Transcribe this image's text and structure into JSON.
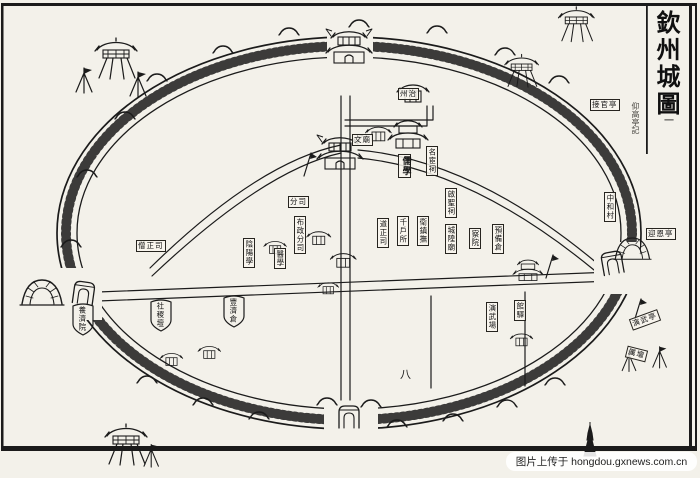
{
  "title": {
    "text": "欽州城圖",
    "volume_mark": "一",
    "side_note": "仰高亭記"
  },
  "watermark": {
    "text": "图片上传于 hongdou.gxnews.com.cn"
  },
  "colors": {
    "ink": "#1b1b1b",
    "paper": "#f3f1ea",
    "watermark_bg": "#ffffff"
  },
  "marks": {
    "south_road": "八"
  },
  "labels": [
    {
      "text": "分司"
    },
    {
      "text": "布政分司"
    },
    {
      "text": "陰陽學"
    },
    {
      "text": "醫學"
    },
    {
      "text": "僧正司"
    },
    {
      "text": "文廟"
    },
    {
      "text": "儒學"
    },
    {
      "text": "名宦祠"
    },
    {
      "text": "啟聖祠"
    },
    {
      "text": "道正司"
    },
    {
      "text": "千戶所"
    },
    {
      "text": "衛鎮撫"
    },
    {
      "text": "城隍廟"
    },
    {
      "text": "察院"
    },
    {
      "text": "預備倉"
    },
    {
      "text": "館驛"
    },
    {
      "text": "演武場"
    },
    {
      "text": "社稷壇"
    },
    {
      "text": "豐濟倉"
    },
    {
      "text": "養濟院"
    },
    {
      "text": "中和村"
    },
    {
      "text": "迎恩亭"
    },
    {
      "text": "接官亭"
    },
    {
      "text": "演武亭"
    },
    {
      "text": "州治"
    },
    {
      "text": "厲壇"
    }
  ]
}
